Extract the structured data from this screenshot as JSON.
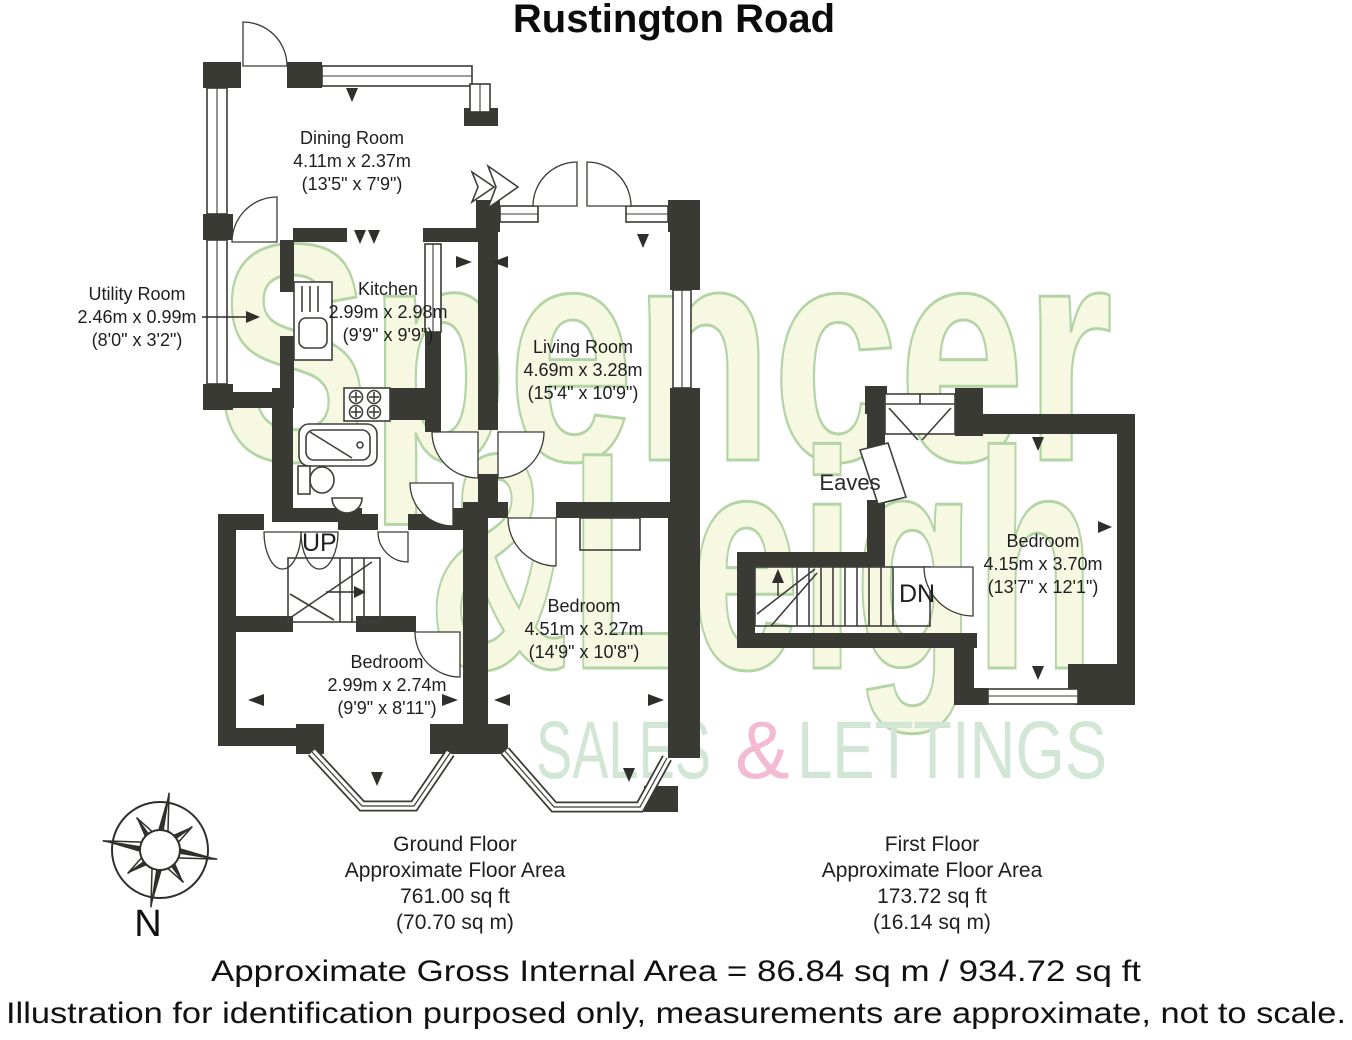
{
  "title": "Rustington Road",
  "watermark": {
    "line1": "Spencer",
    "line2": "&Leigh",
    "tagline": {
      "word1": "SALES",
      "amp": "&",
      "word2": "LETTINGS"
    },
    "colors": {
      "fill": "#f6f8e2",
      "outline": "#b3d4a4",
      "tagline_green": "#d2e6d6",
      "tagline_pink": "#f3bad4",
      "wall": "#3a3a35"
    }
  },
  "rooms": {
    "dining": {
      "name": "Dining Room",
      "metric": "4.11m x 2.37m",
      "imperial": "(13'5\" x 7'9\")"
    },
    "utility": {
      "name": "Utility Room",
      "metric": "2.46m x 0.99m",
      "imperial": "(8'0\" x 3'2\")"
    },
    "kitchen": {
      "name": "Kitchen",
      "metric": "2.99m x 2.98m",
      "imperial": "(9'9\" x 9'9\")"
    },
    "living": {
      "name": "Living Room",
      "metric": "4.69m x 3.28m",
      "imperial": "(15'4\" x 10'9\")"
    },
    "bedroom_gf_right": {
      "name": "Bedroom",
      "metric": "4.51m x 3.27m",
      "imperial": "(14'9\" x 10'8\")"
    },
    "bedroom_gf_left": {
      "name": "Bedroom",
      "metric": "2.99m x 2.74m",
      "imperial": "(9'9\" x 8'11\")"
    },
    "bedroom_ff": {
      "name": "Bedroom",
      "metric": "4.15m x 3.70m",
      "imperial": "(13'7\" x 12'1\")"
    },
    "eaves_label": "Eaves",
    "up_label": "UP",
    "dn_label": "DN"
  },
  "floors": {
    "ground": {
      "name": "Ground Floor",
      "area_line": "Approximate Floor Area",
      "sqft": "761.00 sq ft",
      "sqm": "(70.70 sq m)"
    },
    "first": {
      "name": "First Floor",
      "area_line": "Approximate Floor Area",
      "sqft": "173.72 sq ft",
      "sqm": "(16.14 sq m)"
    }
  },
  "footer": {
    "gross_area": "Approximate Gross Internal Area = 86.84 sq m / 934.72 sq ft",
    "disclaimer": "Illustration for identification purposed only, measurements are approximate, not to scale."
  },
  "compass": {
    "north_label": "N"
  }
}
